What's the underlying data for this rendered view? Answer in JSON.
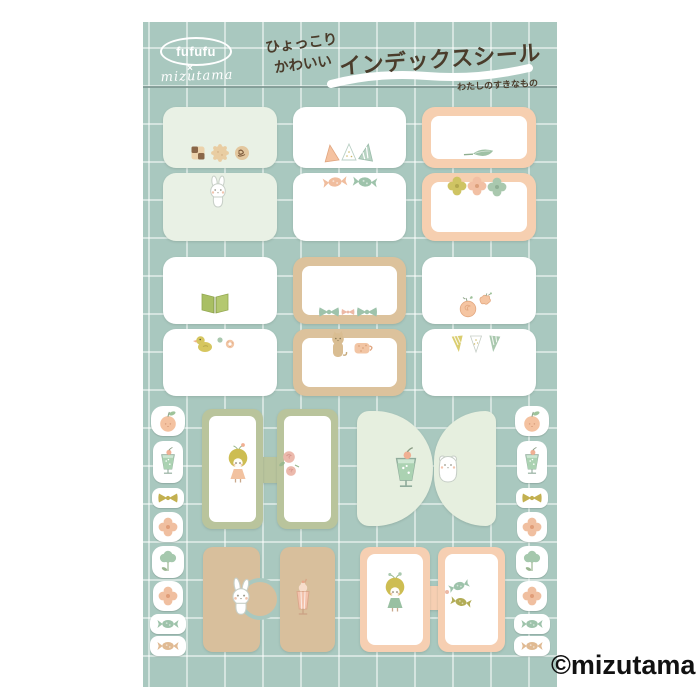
{
  "page": {
    "bg": "#ffffff",
    "copyright": "©mizutama"
  },
  "sheet": {
    "bg_color": "#a9c8bf",
    "grid_color": "#cfe2db",
    "divider_color": "#7c9790",
    "header": {
      "brand": "fufufu",
      "collab_mark": "×",
      "brand2": "mizutama",
      "tagline_1": "ひょっこり",
      "tagline_2": "かわいい",
      "title": "インデックスシール",
      "subtitle": "わたしのすきなもの",
      "text_color": "#4a3c2b"
    },
    "palette": {
      "mint_card": "#e9f1e5",
      "white_card": "#ffffff",
      "peach": "#f6cfb0",
      "tan": "#dcc29c",
      "olive_green": "#b9c49c",
      "mint_tab": "#e6efdf",
      "tan_solid": "#d8bf9c"
    },
    "stickers": {
      "row1": [
        "cookies",
        "bunny",
        "triangle-garland",
        "candies",
        "leaf",
        "flowers"
      ],
      "row2": [
        "open-book",
        "duck-and-sweets",
        "bows",
        "cat-and-mug",
        "apricots",
        "pennants"
      ],
      "row3": [
        "girl-peach-dress",
        "roses",
        "cream-soda",
        "hamster"
      ],
      "row4": [
        "rabbit",
        "milkshake",
        "girl-green-dress",
        "candies"
      ],
      "margin_strip": [
        "apple",
        "cream-soda",
        "bow",
        "flower",
        "tulip",
        "flower",
        "candy",
        "candy"
      ]
    }
  }
}
